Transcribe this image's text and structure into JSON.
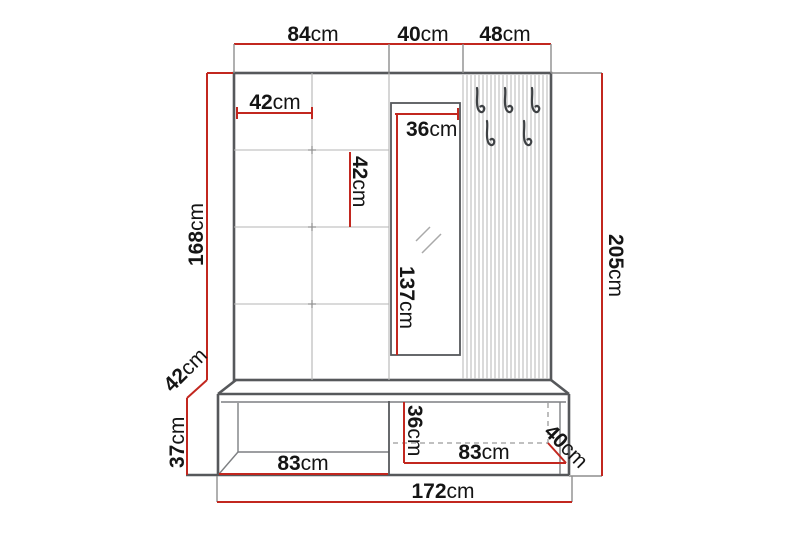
{
  "page": {
    "type": "furniture-dimension-diagram",
    "subject": "hallway wardrobe set with padded panel, mirror, coat-hook panel and shoe bench",
    "background": "#ffffff"
  },
  "colors": {
    "dimension_red": "#c2271f",
    "outline_dark": "#56585b",
    "grid_gray": "#b5b5b5",
    "hook_dark": "#3e4144",
    "text": "#151515"
  },
  "unit": "cm",
  "dimensions": {
    "top_section_left": {
      "value": "84",
      "unit": "cm"
    },
    "top_section_middle": {
      "value": "40",
      "unit": "cm"
    },
    "top_section_right": {
      "value": "48",
      "unit": "cm"
    },
    "panel_tile_width": {
      "value": "42",
      "unit": "cm"
    },
    "panel_tile_height": {
      "value": "42",
      "unit": "cm"
    },
    "panel_height": {
      "value": "168",
      "unit": "cm"
    },
    "mirror_width": {
      "value": "36",
      "unit": "cm"
    },
    "mirror_height": {
      "value": "137",
      "unit": "cm"
    },
    "total_height": {
      "value": "205",
      "unit": "cm"
    },
    "bench_depth": {
      "value": "42",
      "unit": "cm"
    },
    "bench_height": {
      "value": "37",
      "unit": "cm"
    },
    "bench_left_width": {
      "value": "83",
      "unit": "cm"
    },
    "bench_opening_height": {
      "value": "36",
      "unit": "cm"
    },
    "bench_right_width": {
      "value": "83",
      "unit": "cm"
    },
    "bench_right_depth": {
      "value": "40",
      "unit": "cm"
    },
    "total_width": {
      "value": "172",
      "unit": "cm"
    }
  }
}
